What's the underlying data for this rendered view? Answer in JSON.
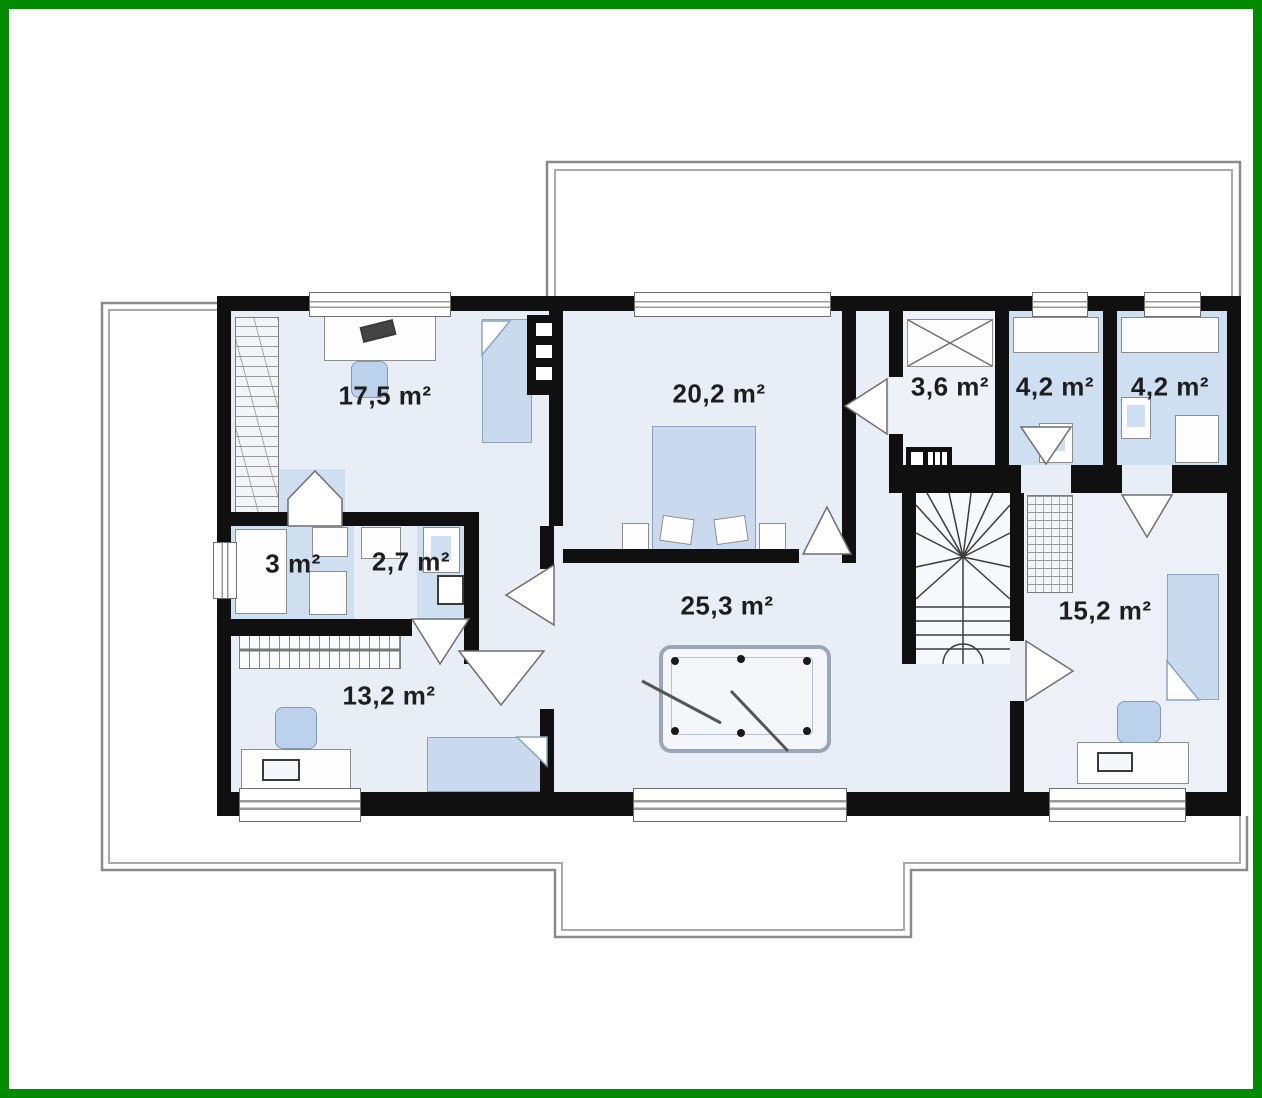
{
  "plan": {
    "title": "upper-floor-plan",
    "rooms": [
      {
        "id": "bedroom-top-left",
        "area_label": "17,5 m²"
      },
      {
        "id": "bedroom-top-center",
        "area_label": "20,2 m²"
      },
      {
        "id": "closet-top-right",
        "area_label": "3,6 m²"
      },
      {
        "id": "bathroom-1",
        "area_label": "4,2 m²"
      },
      {
        "id": "bathroom-2",
        "area_label": "4,2 m²"
      },
      {
        "id": "shower-room",
        "area_label": "3 m²"
      },
      {
        "id": "wc",
        "area_label": "2,7 m²"
      },
      {
        "id": "hall-billiard",
        "area_label": "25,3 m²"
      },
      {
        "id": "bedroom-right",
        "area_label": "15,2 m²"
      },
      {
        "id": "bedroom-bottom-left",
        "area_label": "13,2 m²"
      }
    ],
    "colors": {
      "frame_green": "#028a02",
      "wall_black": "#101010",
      "floor_light": "#e9edf5",
      "floor_bathroom": "#cfdff2",
      "furniture_blue": "#c9daee",
      "roof_outline_gray": "#8a8a8a"
    }
  }
}
